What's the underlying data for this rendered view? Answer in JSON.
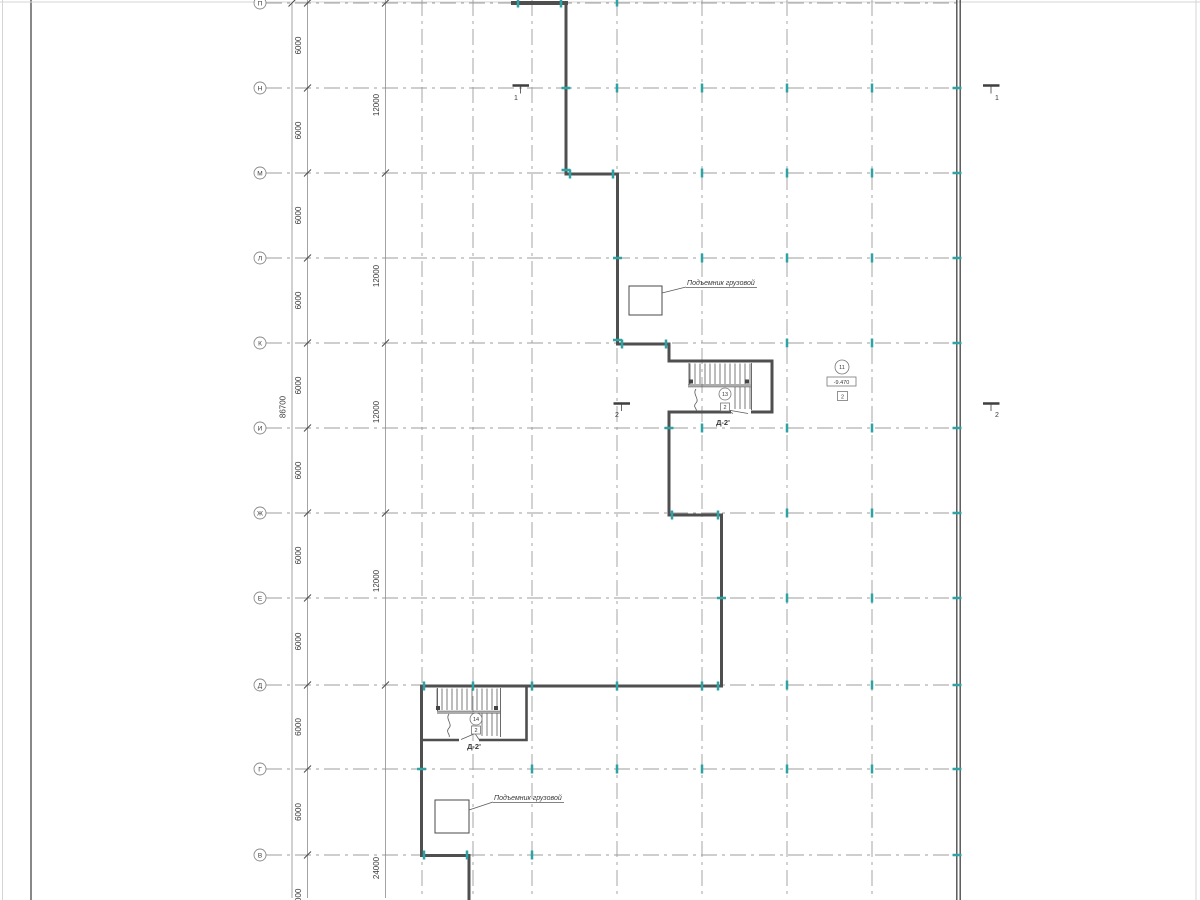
{
  "title": "Floor plan drawing",
  "colors": {
    "bg": "#ffffff",
    "grid": "#9c9c9c",
    "dim": "#8c8c8c",
    "slash": "#4a4a4a",
    "wall": "#4f4f4f",
    "thin": "#5a5a5a",
    "tick": "#2fa3a3",
    "text": "#3a3a3a",
    "frame_light": "#d5d5d5",
    "frame_dark": "#555555"
  },
  "frame": {
    "lines": [
      [
        2.5,
        0,
        2.5,
        900,
        "frame_light",
        1
      ],
      [
        31,
        0,
        31,
        900,
        "frame_dark",
        1.4
      ],
      [
        1196,
        0,
        1196,
        900,
        "frame_light",
        1
      ],
      [
        0,
        2,
        1200,
        2,
        "frame_light",
        1
      ]
    ]
  },
  "grid": {
    "rows": [
      {
        "label": "П",
        "y": 3
      },
      {
        "label": "Н",
        "y": 88
      },
      {
        "label": "М",
        "y": 173
      },
      {
        "label": "Л",
        "y": 258
      },
      {
        "label": "К",
        "y": 343
      },
      {
        "label": "И",
        "y": 428
      },
      {
        "label": "Ж",
        "y": 513
      },
      {
        "label": "Е",
        "y": 598
      },
      {
        "label": "Д",
        "y": 685
      },
      {
        "label": "Г",
        "y": 769
      },
      {
        "label": "В",
        "y": 855
      }
    ],
    "row_x1": 266,
    "row_x2": 958,
    "cols": [
      422,
      473,
      532,
      617,
      702,
      787,
      872
    ],
    "col_y1": 0,
    "col_y2": 898,
    "circle_x": 260,
    "circle_r": 6
  },
  "dims": {
    "chains": [
      {
        "x": 307.5,
        "y1": 0,
        "y2": 898,
        "ticks": [
          3,
          88,
          173,
          258,
          343,
          428,
          513,
          598,
          685,
          769,
          855
        ],
        "labels": [
          [
            "6000",
            45.5
          ],
          [
            "6000",
            130.5
          ],
          [
            "6000",
            215.5
          ],
          [
            "6000",
            300.5
          ],
          [
            "6000",
            385.5
          ],
          [
            "6000",
            470.5
          ],
          [
            "6000",
            555.5
          ],
          [
            "6000",
            641.5
          ],
          [
            "6000",
            727
          ],
          [
            "6000",
            812
          ],
          [
            "6000",
            897.5
          ]
        ]
      },
      {
        "x": 385.5,
        "y1": 0,
        "y2": 898,
        "ticks": [
          3,
          173,
          343,
          513,
          685
        ],
        "labels": [
          [
            "12000",
            105
          ],
          [
            "12000",
            276
          ],
          [
            "12000",
            412
          ],
          [
            "12000",
            581
          ],
          [
            "24000",
            868
          ]
        ]
      },
      {
        "x": 292,
        "y1": 3,
        "y2": 898,
        "ticks": [
          3
        ],
        "labels": [
          [
            "86700",
            407
          ]
        ]
      }
    ]
  },
  "walls": [
    [
      "M511,3 H568",
      4
    ],
    [
      "M566,1 V174 H617.5 V344 H669 V361 H772 V412 H751",
      3
    ],
    [
      "M731,412 H669 V515 H721.5 V686 H421.5 V855.5 H469 V900",
      3
    ],
    [
      "M956.8,0 V900",
      1.4
    ],
    [
      "M960.2,0 V900",
      1.4
    ],
    [
      "M526.5,686 V740 H479",
      2.6
    ],
    [
      "M459,740 H421.5",
      2.6
    ]
  ],
  "ticks": [
    [
      518,
      3,
      "v"
    ],
    [
      561,
      3,
      "v"
    ],
    [
      617,
      2,
      "v"
    ],
    [
      566,
      88,
      "h"
    ],
    [
      566,
      170,
      "h"
    ],
    [
      570,
      174,
      "v"
    ],
    [
      613,
      174,
      "v"
    ],
    [
      617.5,
      258,
      "h"
    ],
    [
      617.5,
      340,
      "h"
    ],
    [
      622,
      344,
      "v"
    ],
    [
      666,
      344,
      "v"
    ],
    [
      617,
      88,
      "v"
    ],
    [
      702,
      88,
      "v"
    ],
    [
      787,
      88,
      "v"
    ],
    [
      872,
      88,
      "v"
    ],
    [
      957,
      88,
      "h"
    ],
    [
      702,
      173,
      "v"
    ],
    [
      787,
      173,
      "v"
    ],
    [
      872,
      173,
      "v"
    ],
    [
      957,
      173,
      "h"
    ],
    [
      702,
      258,
      "v"
    ],
    [
      787,
      258,
      "v"
    ],
    [
      872,
      258,
      "v"
    ],
    [
      957,
      258,
      "h"
    ],
    [
      787,
      343,
      "v"
    ],
    [
      872,
      343,
      "v"
    ],
    [
      957,
      343,
      "h"
    ],
    [
      669,
      428,
      "h"
    ],
    [
      702,
      428,
      "v"
    ],
    [
      787,
      428,
      "v"
    ],
    [
      872,
      428,
      "v"
    ],
    [
      957,
      428,
      "h"
    ],
    [
      672,
      515,
      "v"
    ],
    [
      718,
      515,
      "v"
    ],
    [
      787,
      513,
      "v"
    ],
    [
      872,
      513,
      "v"
    ],
    [
      957,
      513,
      "h"
    ],
    [
      721.5,
      598,
      "h"
    ],
    [
      787,
      598,
      "v"
    ],
    [
      872,
      598,
      "v"
    ],
    [
      957,
      598,
      "h"
    ],
    [
      424,
      686,
      "v"
    ],
    [
      473,
      686,
      "v"
    ],
    [
      532,
      686,
      "v"
    ],
    [
      617,
      686,
      "v"
    ],
    [
      702,
      686,
      "v"
    ],
    [
      718,
      686,
      "v"
    ],
    [
      787,
      685,
      "v"
    ],
    [
      872,
      685,
      "v"
    ],
    [
      957,
      685,
      "h"
    ],
    [
      421.5,
      769,
      "h"
    ],
    [
      532,
      769,
      "v"
    ],
    [
      617,
      769,
      "v"
    ],
    [
      702,
      769,
      "v"
    ],
    [
      787,
      769,
      "v"
    ],
    [
      872,
      769,
      "v"
    ],
    [
      957,
      769,
      "h"
    ],
    [
      424,
      855,
      "v"
    ],
    [
      467,
      855,
      "v"
    ],
    [
      532,
      855,
      "v"
    ],
    [
      957,
      855,
      "h"
    ]
  ],
  "stairs": [
    {
      "treads": [
        {
          "x1": 690,
          "x2": 750,
          "step": 5,
          "y1": 363.5,
          "y2": 384
        },
        {
          "x1": 735,
          "x2": 750,
          "step": 5,
          "y1": 387,
          "y2": 409
        }
      ],
      "lines": [
        [
          688,
          385,
          751,
          385
        ],
        [
          688,
          386.8,
          751,
          386.8
        ],
        [
          751.5,
          363,
          751.5,
          410
        ],
        [
          689,
          363,
          689,
          385
        ]
      ],
      "squares": [
        [
          689,
          379.5
        ],
        [
          745,
          379.5
        ]
      ],
      "scurve": "M696,389 C692,394 700,399 696,403 C692,407 698,409 696,411",
      "door": [
        [
          725,
          409.5,
          733,
          413.5
        ],
        [
          725,
          409.5,
          748,
          413.5
        ]
      ],
      "num": {
        "x": 725,
        "y": 394,
        "t": "13"
      },
      "dbox": {
        "x": 720.5,
        "y": 403,
        "w": 9,
        "h": 8,
        "t": "2"
      },
      "label": {
        "x": 723,
        "y": 425,
        "t": "Д-2'"
      }
    },
    {
      "treads": [
        {
          "x1": 437,
          "x2": 497,
          "step": 5,
          "y1": 688.5,
          "y2": 710
        },
        {
          "x1": 482,
          "x2": 497,
          "step": 5,
          "y1": 713,
          "y2": 736
        }
      ],
      "lines": [
        [
          437,
          711.2,
          500,
          711.2
        ],
        [
          437,
          713,
          500,
          713
        ],
        [
          500.5,
          688,
          500.5,
          737
        ],
        [
          437.5,
          688,
          437.5,
          711
        ]
      ],
      "squares": [
        [
          436,
          706
        ],
        [
          494,
          706
        ]
      ],
      "scurve": "M449,714 C445,719 453,724 449,728 C445,732 451,735 449,737",
      "door": [
        [
          475,
          733.5,
          461,
          739.5
        ],
        [
          475,
          733.5,
          479,
          739.5
        ]
      ],
      "num": {
        "x": 476,
        "y": 719,
        "t": "14"
      },
      "dbox": {
        "x": 471.5,
        "y": 726,
        "w": 9,
        "h": 8,
        "t": "2"
      },
      "label": {
        "x": 474,
        "y": 749,
        "t": "Д-2'"
      }
    }
  ],
  "hoists": [
    {
      "box": [
        629,
        286,
        33,
        29
      ],
      "leader": [
        662,
        293,
        686,
        287
      ],
      "underline": [
        686,
        287.5,
        757,
        287.5
      ],
      "t": "Подъемник грузовой",
      "tx": 687,
      "ty": 285
    },
    {
      "box": [
        435,
        800,
        34,
        33
      ],
      "leader": [
        469,
        810,
        493,
        802
      ],
      "underline": [
        493,
        802.5,
        564,
        802.5
      ],
      "t": "Подъемник грузовой",
      "tx": 494,
      "ty": 800
    }
  ],
  "note": {
    "circle": {
      "x": 842,
      "y": 367,
      "r": 7,
      "t": "11"
    },
    "level": {
      "x": 827,
      "y": 377,
      "w": 29,
      "h": 9,
      "t": "-9.470"
    },
    "box": {
      "x": 837.5,
      "y": 391.5,
      "w": 10,
      "h": 9,
      "t": "2"
    }
  },
  "sections": [
    {
      "bar": [
        512.5,
        85.5,
        529,
        85.5
      ],
      "stem": [
        520.5,
        85.5,
        520.5,
        93.5
      ],
      "t": "1",
      "tx": 516,
      "ty": 100
    },
    {
      "bar": [
        983,
        85.5,
        999.5,
        85.5
      ],
      "stem": [
        991,
        85.5,
        991,
        93.5
      ],
      "t": "1",
      "tx": 997,
      "ty": 100
    },
    {
      "bar": [
        613.5,
        403.5,
        630,
        403.5
      ],
      "stem": [
        621.5,
        403.5,
        621.5,
        411
      ],
      "t": "2",
      "tx": 617,
      "ty": 417
    },
    {
      "bar": [
        983,
        403.5,
        999.5,
        403.5
      ],
      "stem": [
        991,
        403.5,
        991,
        411
      ],
      "t": "2",
      "tx": 997,
      "ty": 417
    }
  ]
}
